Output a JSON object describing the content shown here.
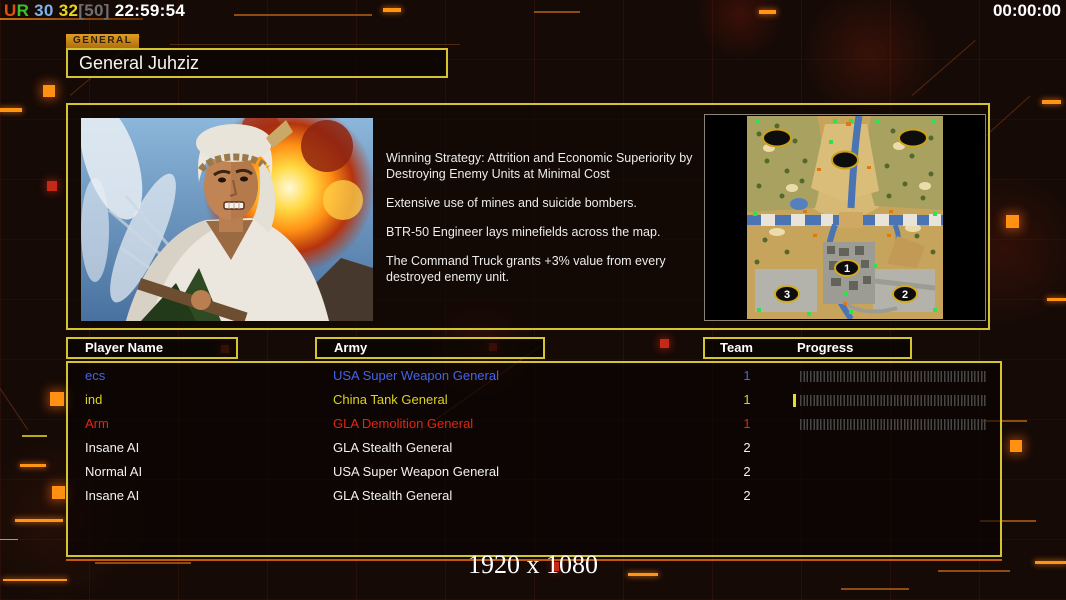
{
  "window": {
    "resolution_label": "1920 x 1080"
  },
  "status_bar": {
    "segments": [
      {
        "text": "U",
        "color": "#e0500e"
      },
      {
        "text": "R",
        "color": "#3cc426"
      },
      {
        "text": " 30 ",
        "color": "#7fb2e8"
      },
      {
        "text": "32",
        "color": "#e8d51e"
      },
      {
        "text": "[50]",
        "color": "#6f6f6f"
      },
      {
        "text": " 22:59:54",
        "color": "#ffffff"
      }
    ],
    "match_timer": "00:00:00"
  },
  "general_panel": {
    "tab_label": "GENERAL",
    "general_name": "General Juhziz",
    "strategy_paragraphs": [
      "Winning Strategy: Attrition and Economic Superiority by\n Destroying Enemy Units at Minimal Cost",
      "Extensive use of mines and suicide bombers.",
      "BTR-50 Engineer lays minefields across the map.",
      "The Command Truck grants +3% value from every\n destroyed enemy unit."
    ]
  },
  "map_preview": {
    "start_markers": [
      "1",
      "2",
      "3"
    ]
  },
  "players_table": {
    "headers": {
      "player_name": "Player Name",
      "army": "Army",
      "team": "Team",
      "progress": "Progress"
    },
    "rows": [
      {
        "name": "ecs",
        "army": "USA Super Weapon General",
        "team": "1",
        "color": "#4663e8",
        "progress_bar": true,
        "progress_ticks": 0
      },
      {
        "name": "ind",
        "army": "China Tank General",
        "team": "1",
        "color": "#d9d41f",
        "progress_bar": true,
        "progress_ticks": 1
      },
      {
        "name": "Arm",
        "army": "GLA Demolition General",
        "team": "1",
        "color": "#e02615",
        "progress_bar": true,
        "progress_ticks": 0
      },
      {
        "name": "Insane AI",
        "army": "GLA Stealth General",
        "team": "2",
        "color": "#f2f2f2",
        "progress_bar": false,
        "progress_ticks": 0
      },
      {
        "name": "Normal AI",
        "army": "USA Super Weapon General",
        "team": "2",
        "color": "#f2f2f2",
        "progress_bar": false,
        "progress_ticks": 0
      },
      {
        "name": "Insane AI",
        "army": "GLA Stealth General",
        "team": "2",
        "color": "#f2f2f2",
        "progress_bar": false,
        "progress_ticks": 0
      }
    ]
  },
  "colors": {
    "panel_border": "#d6c42f",
    "accent_orange": "#ff8d12",
    "decor_red": "#cf2c18",
    "tab_background": "#d4901c"
  }
}
